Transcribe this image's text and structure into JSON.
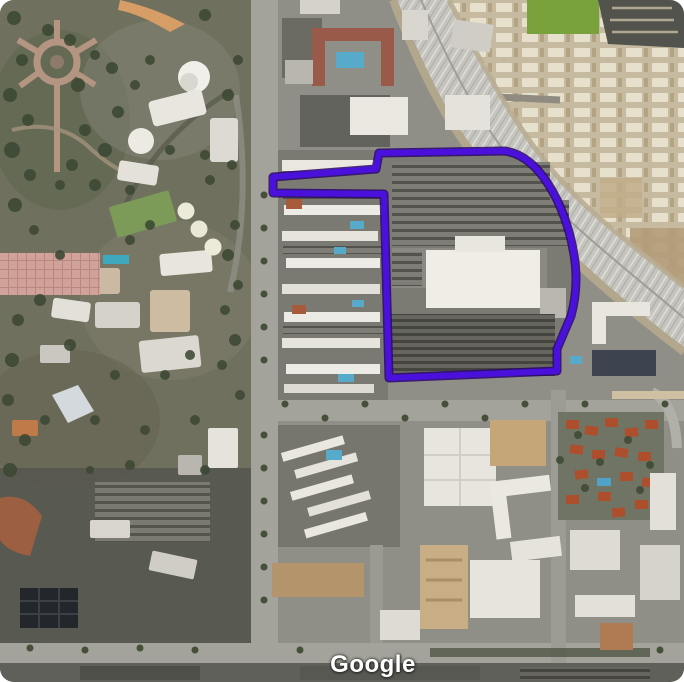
{
  "map": {
    "type": "satellite-view",
    "attribution": "Google",
    "attribution_color": "#ffffff",
    "overlay": {
      "name": "highlighted-parcel-outline",
      "stroke_color": "#4a10dc",
      "outer_stroke_color": "#2a056e",
      "path": "M273,177 L376,169 L379,153 L504,151 C523,153 538,168 548,184 C560,202 570,229 574,255 C577,273 577,294 571,316 L557,349 L557,371 L389,378 L384,194 L273,193 Z"
    },
    "palette": {
      "park_green": "#6f705e",
      "urban_gray": "#8f8f88",
      "freeway_gray": "#c5c4be",
      "parking_dark": "#686862",
      "roof_white": "#eae8e1",
      "roof_red": "#ad4f2c",
      "pool_blue": "#4fa3c8",
      "trailer_tan": "#c6baa0"
    }
  }
}
